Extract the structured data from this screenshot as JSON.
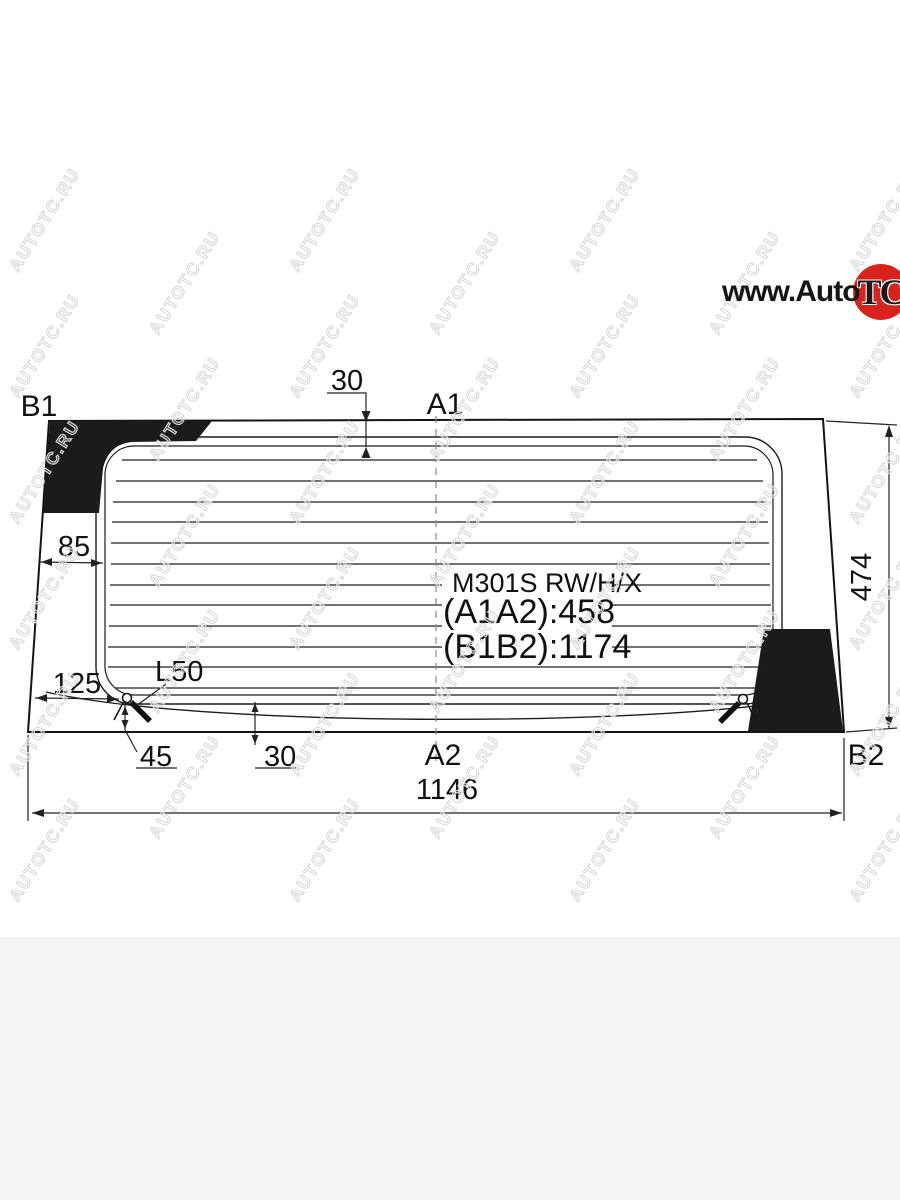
{
  "page": {
    "background_color": "#ffffff",
    "footer_color": "#f4f4f4"
  },
  "watermark": {
    "text": "AUTOTC.RU"
  },
  "logo": {
    "prefix": "www.Auto",
    "circle_text": "TC",
    "suffix": ".ru",
    "circle_color": "#d8231d"
  },
  "diagram": {
    "part_labels": {
      "b1": "B1",
      "a1": "A1",
      "a2": "A2",
      "b2": "B2"
    },
    "center_text": {
      "model": "M301S RW/H/X",
      "a1a2": "(A1A2):458",
      "b1b2": "(B1B2):1174"
    },
    "dimensions": {
      "top_inset": "30",
      "left_edge": "85",
      "left_corner": "125",
      "wire": "L50",
      "corner_drop": "45",
      "bottom_inset": "30",
      "height": "474",
      "width": "1146"
    }
  }
}
